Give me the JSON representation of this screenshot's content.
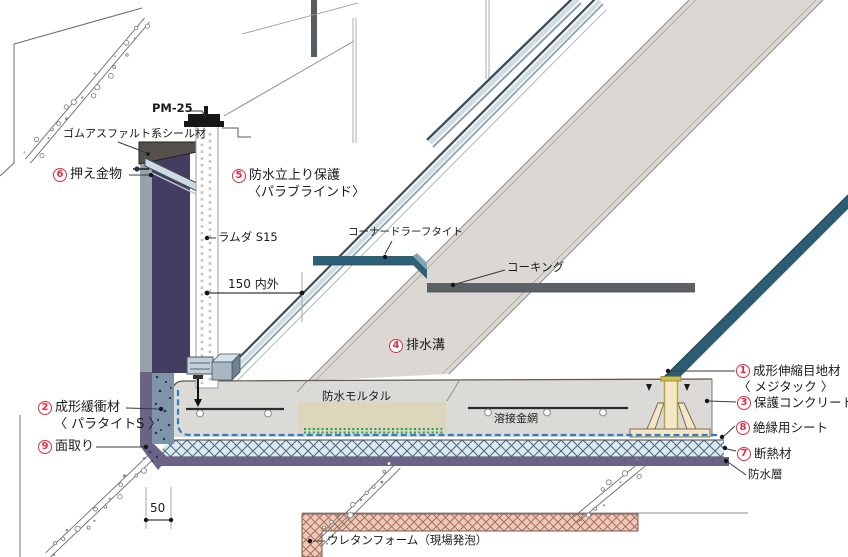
{
  "colors": {
    "accent_red": "#dd2e44",
    "teal_strip": "#2d6077",
    "navy_parapet": "#443d62",
    "waterproof_purple": "#6b6285",
    "insulation_blue": "#d8ecf7",
    "mortar_beige": "#dcd6bd",
    "foam_pink": "#f3c7b5",
    "caulking_gray": "#5d6165",
    "steel_light": "#d2dde3",
    "concrete_gray": "#dcdad6",
    "isolation_sheet_blue": "#2f80c3",
    "mesh_green_dots": "#2aa24c"
  },
  "callouts": [
    {
      "id": "pm25",
      "number": null,
      "lines": [
        "PM-25"
      ]
    },
    {
      "id": "rubber-asphalt-seal",
      "number": null,
      "lines": [
        "ゴムアスファルト系シール材"
      ]
    },
    {
      "id": "press-metal",
      "number": "6",
      "lines": [
        "押え金物"
      ]
    },
    {
      "id": "upstand-protection",
      "number": "5",
      "lines": [
        "防水立上り保護",
        "〈パラブラインド〉"
      ]
    },
    {
      "id": "lambda-s15",
      "number": null,
      "lines": [
        "ラムダ S15"
      ]
    },
    {
      "id": "corner-drain-tight",
      "number": null,
      "lines": [
        "コーナードラーフタイト"
      ]
    },
    {
      "id": "caulking",
      "number": null,
      "lines": [
        "コーキング"
      ]
    },
    {
      "id": "drainage-channel",
      "number": "4",
      "lines": [
        "排水溝"
      ]
    },
    {
      "id": "waterproof-mortar",
      "number": null,
      "lines": [
        "防水モルタル"
      ]
    },
    {
      "id": "welded-wire-mesh",
      "number": null,
      "lines": [
        "溶接金網"
      ]
    },
    {
      "id": "expansion-joint",
      "number": "1",
      "lines": [
        "成形伸縮目地材",
        "〈 メジタック 〉"
      ]
    },
    {
      "id": "protective-concrete",
      "number": "3",
      "lines": [
        "保護コンクリート"
      ]
    },
    {
      "id": "isolation-sheet",
      "number": "8",
      "lines": [
        "絶縁用シート"
      ]
    },
    {
      "id": "insulation",
      "number": "7",
      "lines": [
        "断熱材"
      ]
    },
    {
      "id": "waterproof-layer",
      "number": null,
      "lines": [
        "防水層"
      ]
    },
    {
      "id": "buffer-material",
      "number": "2",
      "lines": [
        "成形緩衝材",
        "〈 パラタイトS 〉"
      ]
    },
    {
      "id": "chamfer",
      "number": "9",
      "lines": [
        "面取り"
      ]
    },
    {
      "id": "urethane-foam",
      "number": null,
      "lines": [
        "ウレタンフォーム（現場発泡）"
      ]
    }
  ],
  "dimensions": [
    {
      "id": "dim-150",
      "text": "150 内外"
    },
    {
      "id": "dim-50",
      "text": "50"
    }
  ]
}
